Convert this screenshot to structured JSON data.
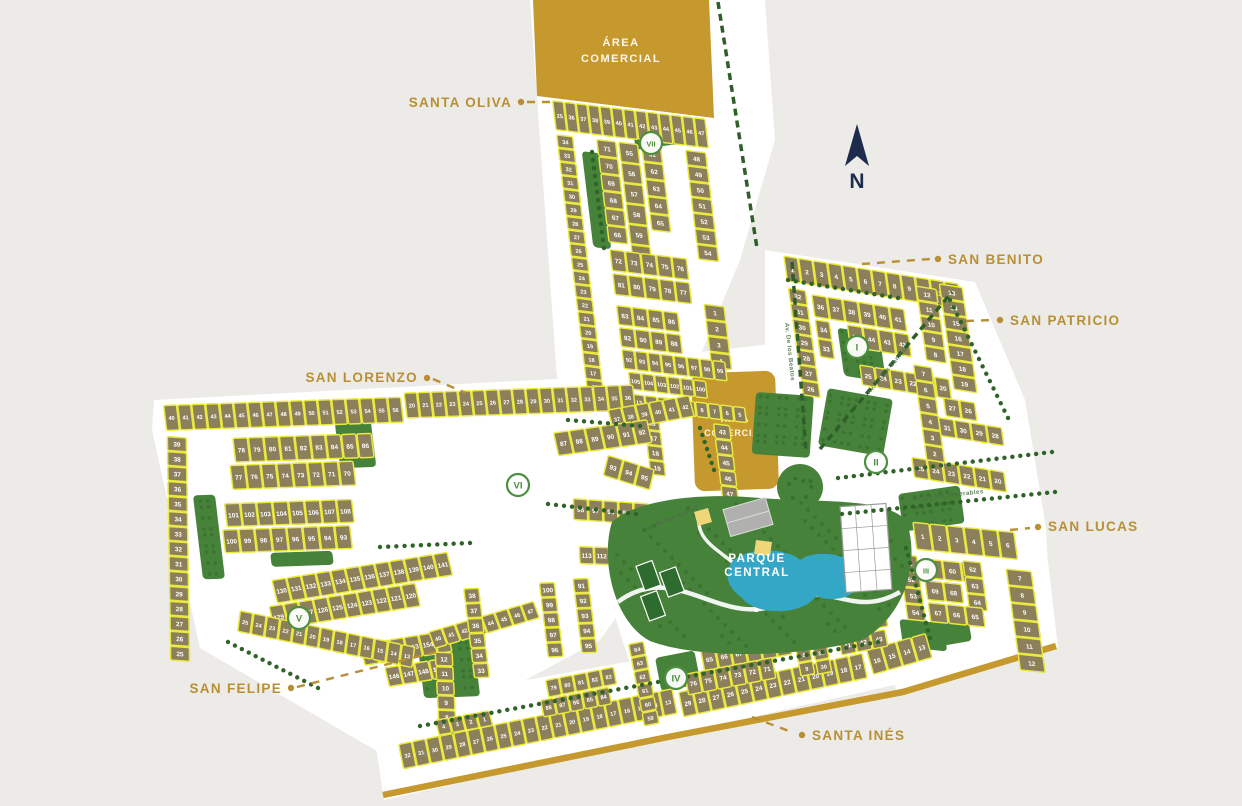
{
  "title": "Residential master plan map",
  "colors": {
    "background": "#ECEBE8",
    "road": "#FFFFFF",
    "lot_fill": "#8C7F5C",
    "lot_stroke": "#E9E93F",
    "green": "#47823A",
    "green_dark": "#2F6327",
    "gold": "#C5992E",
    "lake_blue": "#35A7C6",
    "label_gold": "#B98F33",
    "navy": "#1D2B4D",
    "sector_green": "#4C8F3F",
    "street_text": "#4B6B45"
  },
  "north": {
    "label": "N"
  },
  "areas": {
    "comercial_top": {
      "line1": "ÁREA",
      "line2": "COMERCIAL"
    },
    "comercial_center": {
      "line1": "ÁREA",
      "line2": "COMERCIAL"
    },
    "parque_central": {
      "line1": "PARQUE",
      "line2": "CENTRAL"
    }
  },
  "streets": [
    {
      "name": "Av. De los Beatos",
      "x": 788,
      "y": 352,
      "rot": 84
    },
    {
      "name": "Av. De los Santos",
      "x": 888,
      "y": 372,
      "rot": -50
    },
    {
      "name": "Av. De los Venerables",
      "x": 948,
      "y": 497,
      "rot": -6
    },
    {
      "name": "Av. De los Santos",
      "x": 672,
      "y": 520,
      "rot": -23
    }
  ],
  "sectors": [
    {
      "numeral": "I",
      "x": 857,
      "y": 347
    },
    {
      "numeral": "II",
      "x": 876,
      "y": 462
    },
    {
      "numeral": "III",
      "x": 926,
      "y": 570
    },
    {
      "numeral": "IV",
      "x": 676,
      "y": 678
    },
    {
      "numeral": "V",
      "x": 299,
      "y": 618
    },
    {
      "numeral": "VI",
      "x": 518,
      "y": 485
    },
    {
      "numeral": "VII",
      "x": 651,
      "y": 143
    }
  ],
  "neighborhoods": [
    {
      "id": "santa-oliva",
      "text": "SANTA OLIVA",
      "x": 512,
      "y": 107,
      "anchor": "end",
      "dot": [
        521,
        102
      ],
      "leader": [
        527,
        102,
        556,
        102
      ]
    },
    {
      "id": "san-benito",
      "text": "SAN BENITO",
      "x": 948,
      "y": 264,
      "anchor": "start",
      "dot": [
        938,
        259
      ],
      "leader": [
        862,
        264,
        930,
        259
      ]
    },
    {
      "id": "san-patricio",
      "text": "SAN PATRICIO",
      "x": 1010,
      "y": 325,
      "anchor": "start",
      "dot": [
        1000,
        320
      ],
      "leader": [
        966,
        321,
        992,
        320
      ]
    },
    {
      "id": "san-lorenzo",
      "text": "SAN LORENZO",
      "x": 418,
      "y": 382,
      "anchor": "end",
      "dot": [
        427,
        378
      ],
      "leader": [
        433,
        379,
        466,
        393
      ]
    },
    {
      "id": "san-lucas",
      "text": "SAN LUCAS",
      "x": 1048,
      "y": 531,
      "anchor": "start",
      "dot": [
        1038,
        527
      ],
      "leader": [
        1010,
        530,
        1030,
        528
      ]
    },
    {
      "id": "san-felipe",
      "text": "SAN FELIPE",
      "x": 282,
      "y": 693,
      "anchor": "end",
      "dot": [
        291,
        688
      ],
      "leader": [
        297,
        687,
        436,
        652
      ]
    },
    {
      "id": "santa-ines",
      "text": "SANTA INÉS",
      "x": 812,
      "y": 740,
      "anchor": "start",
      "dot": [
        802,
        735
      ],
      "leader": [
        752,
        717,
        794,
        733
      ]
    }
  ],
  "lot_rows": [
    {
      "g": "top",
      "dir": "h",
      "x": 552,
      "y": 100,
      "w": 11.8,
      "h": 30,
      "nums": "25,36-47"
    },
    {
      "g": "top",
      "dir": "v",
      "x": 552,
      "y": 134,
      "w": 17,
      "h": 13.6,
      "nums": "34-16"
    },
    {
      "g": "top",
      "dir": "v",
      "x": 592,
      "y": 134,
      "w": 20,
      "h": 17.2,
      "nums": "71,70,69,68,67,66"
    },
    {
      "g": "top",
      "dir": "v",
      "x": 614,
      "y": 134,
      "w": 20,
      "h": 20.5,
      "nums": "55-60"
    },
    {
      "g": "top",
      "dir": "v",
      "x": 637,
      "y": 134,
      "w": 20,
      "h": 17.2,
      "nums": "61-65"
    },
    {
      "g": "top",
      "dir": "v",
      "x": 681,
      "y": 134,
      "w": 21,
      "h": 15.7,
      "nums": "48-54"
    },
    {
      "g": "top",
      "dir": "h",
      "x": 592,
      "y": 244,
      "w": 15.5,
      "h": 22,
      "nums": "72-76"
    },
    {
      "g": "top",
      "dir": "h",
      "x": 592,
      "y": 268,
      "w": 15.5,
      "h": 22,
      "nums": "81,80,79,78,77"
    },
    {
      "g": "top",
      "dir": "h",
      "x": 592,
      "y": 300,
      "w": 15.5,
      "h": 20,
      "nums": "83-86"
    },
    {
      "g": "top",
      "dir": "h",
      "x": 592,
      "y": 322,
      "w": 15.5,
      "h": 20,
      "nums": "82,90,89,88"
    },
    {
      "g": "top",
      "dir": "v",
      "x": 681,
      "y": 288,
      "w": 21,
      "h": 16,
      "nums": "1-4"
    },
    {
      "g": "top",
      "dir": "h",
      "x": 592,
      "y": 344,
      "w": 13,
      "h": 20,
      "nums": "92-99"
    },
    {
      "g": "top",
      "dir": "h",
      "x": 596,
      "y": 366,
      "w": 13,
      "h": 18,
      "nums": "105-100"
    },
    {
      "g": "top",
      "dir": "h",
      "x": 572,
      "y": 388,
      "w": 12.6,
      "h": 16,
      "nums": "15-5"
    },
    {
      "g": "top",
      "dir": "v",
      "x": 606,
      "y": 408,
      "w": 16,
      "h": 15,
      "nums": "16-19"
    },
    {
      "g": "top",
      "dir": "v",
      "x": 676,
      "y": 408,
      "w": 17,
      "h": 15.5,
      "nums": "43-47"
    },
    {
      "g": "right",
      "dir": "h",
      "x": 783,
      "y": 255,
      "w": 14.6,
      "h": 26,
      "nums": "1-12"
    },
    {
      "g": "right",
      "dir": "v",
      "x": 783,
      "y": 287,
      "w": 18,
      "h": 15.4,
      "nums": "32-26"
    },
    {
      "g": "right",
      "dir": "h",
      "x": 806,
      "y": 290,
      "w": 15.5,
      "h": 23,
      "nums": "36-41"
    },
    {
      "g": "right",
      "dir": "v",
      "x": 806,
      "y": 315,
      "w": 15,
      "h": 19,
      "nums": "34,33"
    },
    {
      "g": "right",
      "dir": "h",
      "x": 838,
      "y": 315,
      "w": 15.5,
      "h": 23,
      "nums": "35,44,43,42"
    },
    {
      "g": "right",
      "dir": "h",
      "x": 845,
      "y": 354,
      "w": 15,
      "h": 21,
      "nums": "25,24,23,22,21,20"
    },
    {
      "g": "right",
      "dir": "v",
      "x": 938,
      "y": 258,
      "w": 24,
      "h": 15.2,
      "nums": "13-19"
    },
    {
      "g": "right",
      "dir": "v",
      "x": 914,
      "y": 264,
      "w": 21,
      "h": 15,
      "nums": "12,11,10,9,8"
    },
    {
      "g": "right",
      "dir": "v",
      "x": 900,
      "y": 345,
      "w": 19,
      "h": 16,
      "nums": "7-1"
    },
    {
      "g": "right",
      "dir": "h",
      "x": 926,
      "y": 374,
      "w": 16,
      "h": 19,
      "nums": "27,26"
    },
    {
      "g": "right",
      "dir": "h",
      "x": 918,
      "y": 395,
      "w": 16,
      "h": 19,
      "nums": "31,30,29,28"
    },
    {
      "g": "right",
      "dir": "h",
      "x": 885,
      "y": 440,
      "w": 15.5,
      "h": 21,
      "nums": "25,24,23,22,21,20"
    },
    {
      "g": "left",
      "dir": "h",
      "x": 163,
      "y": 405,
      "w": 14,
      "h": 26,
      "nums": "40-56"
    },
    {
      "g": "left",
      "dir": "h",
      "x": 404,
      "y": 401,
      "w": 13.5,
      "h": 26,
      "nums": "20-36"
    },
    {
      "g": "left",
      "dir": "h",
      "x": 605,
      "y": 425,
      "w": 14,
      "h": 22,
      "nums": "37-42",
      "rot": -8
    },
    {
      "g": "left",
      "dir": "v",
      "x": 163,
      "y": 436,
      "w": 20,
      "h": 15,
      "nums": "39-25",
      "rot": 6
    },
    {
      "g": "left",
      "dir": "h",
      "x": 228,
      "y": 440,
      "w": 15.5,
      "h": 25,
      "nums": "78-86"
    },
    {
      "g": "left",
      "dir": "h",
      "x": 222,
      "y": 467,
      "w": 15.5,
      "h": 25,
      "nums": "77,76,75,74,73,72,71,70"
    },
    {
      "g": "left",
      "dir": "h",
      "x": 548,
      "y": 446,
      "w": 16,
      "h": 24,
      "nums": "87-92",
      "rot": -6
    },
    {
      "g": "left",
      "dir": "h",
      "x": 212,
      "y": 505,
      "w": 16,
      "h": 24,
      "nums": "101-108"
    },
    {
      "g": "left",
      "dir": "h",
      "x": 207,
      "y": 531,
      "w": 16,
      "h": 24,
      "nums": "100,99,98,97,96,95,94,93"
    },
    {
      "g": "left",
      "dir": "h",
      "x": 600,
      "y": 470,
      "w": 16,
      "h": 22,
      "nums": "93,94,95",
      "rot": 20
    },
    {
      "g": "left",
      "dir": "h",
      "x": 560,
      "y": 512,
      "w": 15,
      "h": 22,
      "nums": "96-100",
      "rot": 6
    },
    {
      "g": "left",
      "dir": "h",
      "x": 560,
      "y": 560,
      "w": 15,
      "h": 18,
      "nums": "113,112,111,110",
      "rot": 4
    },
    {
      "g": "left",
      "dir": "h",
      "x": 250,
      "y": 583,
      "w": 15,
      "h": 24,
      "nums": "130-141",
      "rot": -7
    },
    {
      "g": "left",
      "dir": "h",
      "x": 244,
      "y": 609,
      "w": 15,
      "h": 24,
      "nums": "129-120",
      "rot": -7
    },
    {
      "g": "left",
      "dir": "h",
      "x": 330,
      "y": 650,
      "w": 15,
      "h": 22,
      "nums": "150-155",
      "rot": -7
    },
    {
      "g": "left",
      "dir": "h",
      "x": 352,
      "y": 674,
      "w": 15,
      "h": 20,
      "nums": "146,147,148,149",
      "rot": -7
    },
    {
      "g": "left",
      "dir": "h",
      "x": 215,
      "y": 612,
      "w": 13.5,
      "h": 22,
      "nums": "25-13",
      "rot": 14
    },
    {
      "g": "left",
      "dir": "v",
      "x": 404,
      "y": 660,
      "w": 18,
      "h": 14.5,
      "nums": "12-6",
      "rot": 4
    },
    {
      "g": "left",
      "dir": "h",
      "x": 396,
      "y": 728,
      "w": 14,
      "h": 16,
      "nums": "4,3,2,1",
      "rot": -8
    },
    {
      "g": "left",
      "dir": "h",
      "x": 400,
      "y": 640,
      "w": 14,
      "h": 18,
      "nums": "40-47",
      "rot": -14
    },
    {
      "g": "left",
      "dir": "v",
      "x": 440,
      "y": 598,
      "w": 16,
      "h": 15,
      "nums": "38-33"
    },
    {
      "g": "left",
      "dir": "v",
      "x": 516,
      "y": 595,
      "w": 16,
      "h": 15,
      "nums": "100,99,98,97,96"
    },
    {
      "g": "left",
      "dir": "v",
      "x": 550,
      "y": 592,
      "w": 16,
      "h": 15,
      "nums": "91-95"
    },
    {
      "g": "left",
      "dir": "h",
      "x": 620,
      "y": 556,
      "w": 15,
      "h": 20,
      "nums": "48-53",
      "rot": 10
    },
    {
      "g": "sl",
      "dir": "h",
      "x": 912,
      "y": 522,
      "w": 17,
      "h": 28,
      "nums": "1-6"
    },
    {
      "g": "sl",
      "dir": "v",
      "x": 1000,
      "y": 560,
      "w": 26,
      "h": 17,
      "nums": "7-12"
    },
    {
      "g": "sl",
      "dir": "v",
      "x": 893,
      "y": 556,
      "w": 19,
      "h": 16.5,
      "nums": "51,52,53,54"
    },
    {
      "g": "sl",
      "dir": "h",
      "x": 918,
      "y": 558,
      "w": 18.5,
      "h": 20,
      "nums": "59,60,61"
    },
    {
      "g": "sl",
      "dir": "v",
      "x": 957,
      "y": 556,
      "w": 19,
      "h": 16.5,
      "nums": "62,63,64"
    },
    {
      "g": "sl",
      "dir": "h",
      "x": 916,
      "y": 580,
      "w": 18.5,
      "h": 20,
      "nums": "69,68"
    },
    {
      "g": "sl",
      "dir": "h",
      "x": 916,
      "y": 602,
      "w": 18.5,
      "h": 20,
      "nums": "67,66,65"
    },
    {
      "g": "static",
      "dir": "h",
      "x": 398,
      "y": 744,
      "w": 14,
      "h": 26,
      "nums": "32-13",
      "rot": -11.5
    },
    {
      "g": "static",
      "dir": "h",
      "x": 678,
      "y": 692,
      "w": 14.5,
      "h": 26,
      "nums": "29-17",
      "rot": -12
    },
    {
      "g": "static",
      "dir": "h",
      "x": 866,
      "y": 650,
      "w": 15.5,
      "h": 26,
      "nums": "16,15,14,13",
      "rot": -16
    },
    {
      "g": "static",
      "dir": "h",
      "x": 700,
      "y": 650,
      "w": 15,
      "h": 22,
      "nums": "65,66,67,68,69,70",
      "rot": -11
    },
    {
      "g": "static",
      "dir": "h",
      "x": 684,
      "y": 674,
      "w": 15,
      "h": 22,
      "nums": "76,75,74,73,72,71",
      "rot": -11
    },
    {
      "g": "static",
      "dir": "v",
      "x": 628,
      "y": 644,
      "w": 16,
      "h": 14,
      "nums": "64,63,62,61,60,59",
      "rot": -11
    },
    {
      "g": "static",
      "dir": "v",
      "x": 790,
      "y": 622,
      "w": 15,
      "h": 14,
      "nums": "6,7,8,9",
      "rot": -11
    },
    {
      "g": "static",
      "dir": "v",
      "x": 807,
      "y": 620,
      "w": 15,
      "h": 14,
      "nums": "33,32,31,30",
      "rot": -11
    },
    {
      "g": "static",
      "dir": "h",
      "x": 838,
      "y": 618,
      "w": 16,
      "h": 18,
      "nums": "46,45,44",
      "rot": -11
    },
    {
      "g": "static",
      "dir": "h",
      "x": 838,
      "y": 638,
      "w": 16,
      "h": 18,
      "nums": "41,42,43",
      "rot": -11
    },
    {
      "g": "static",
      "dir": "h",
      "x": 545,
      "y": 680,
      "w": 14,
      "h": 18,
      "nums": "79,80,81,82,83",
      "rot": -11
    },
    {
      "g": "static",
      "dir": "h",
      "x": 540,
      "y": 700,
      "w": 14,
      "h": 18,
      "nums": "88,87,86,85,84",
      "rot": -11
    }
  ],
  "green_areas": [
    {
      "g": "top",
      "x": 576,
      "y": 148,
      "w": 18,
      "h": 96
    },
    {
      "g": "static",
      "x": 633,
      "y": 130,
      "w": 46,
      "h": 20,
      "rot": -8
    },
    {
      "g": "right",
      "x": 828,
      "y": 320,
      "w": 42,
      "h": 48
    },
    {
      "g": "static",
      "x": 756,
      "y": 392,
      "w": 58,
      "h": 62,
      "rot": 4
    },
    {
      "g": "static",
      "x": 828,
      "y": 388,
      "w": 66,
      "h": 58,
      "rot": 10
    },
    {
      "g": "static",
      "x": 898,
      "y": 494,
      "w": 62,
      "h": 38,
      "rot": -8
    },
    {
      "g": "static",
      "x": 928,
      "y": 622,
      "w": 40,
      "h": 26,
      "rot": -10
    },
    {
      "g": "left",
      "x": 332,
      "y": 428,
      "w": 36,
      "h": 46
    },
    {
      "g": "left",
      "x": 182,
      "y": 496,
      "w": 22,
      "h": 84
    },
    {
      "g": "left",
      "x": 252,
      "y": 556,
      "w": 62,
      "h": 14
    },
    {
      "g": "left",
      "x": 388,
      "y": 646,
      "w": 56,
      "h": 60
    },
    {
      "g": "left",
      "x": 558,
      "y": 410,
      "w": 72,
      "h": 12,
      "rot": 3
    },
    {
      "g": "static",
      "x": 655,
      "y": 658,
      "w": 40,
      "h": 34,
      "rot": -11
    },
    {
      "g": "sl",
      "x": 885,
      "y": 622,
      "w": 44,
      "h": 28
    }
  ],
  "tree_lines": [
    {
      "x1": 838,
      "y1": 478,
      "x2": 1052,
      "y2": 452
    },
    {
      "x1": 842,
      "y1": 514,
      "x2": 1055,
      "y2": 492
    },
    {
      "x1": 788,
      "y1": 280,
      "x2": 898,
      "y2": 298
    },
    {
      "x1": 950,
      "y1": 300,
      "x2": 1008,
      "y2": 418
    },
    {
      "x1": 568,
      "y1": 420,
      "x2": 640,
      "y2": 426
    },
    {
      "x1": 548,
      "y1": 504,
      "x2": 636,
      "y2": 514
    },
    {
      "x1": 380,
      "y1": 547,
      "x2": 470,
      "y2": 543
    },
    {
      "x1": 228,
      "y1": 642,
      "x2": 318,
      "y2": 688
    },
    {
      "x1": 592,
      "y1": 152,
      "x2": 604,
      "y2": 248
    },
    {
      "x1": 700,
      "y1": 428,
      "x2": 714,
      "y2": 470
    },
    {
      "x1": 680,
      "y1": 678,
      "x2": 878,
      "y2": 642
    },
    {
      "x1": 420,
      "y1": 726,
      "x2": 658,
      "y2": 682
    },
    {
      "x1": 906,
      "y1": 548,
      "x2": 930,
      "y2": 638
    }
  ],
  "medians": [
    {
      "x1": 718,
      "y1": 2,
      "x2": 757,
      "y2": 248
    },
    {
      "x1": 792,
      "y1": 262,
      "x2": 806,
      "y2": 452
    },
    {
      "x1": 820,
      "y1": 449,
      "x2": 952,
      "y2": 292
    }
  ],
  "boundary_road": "383,795 668,737 903,692 1056,646"
}
